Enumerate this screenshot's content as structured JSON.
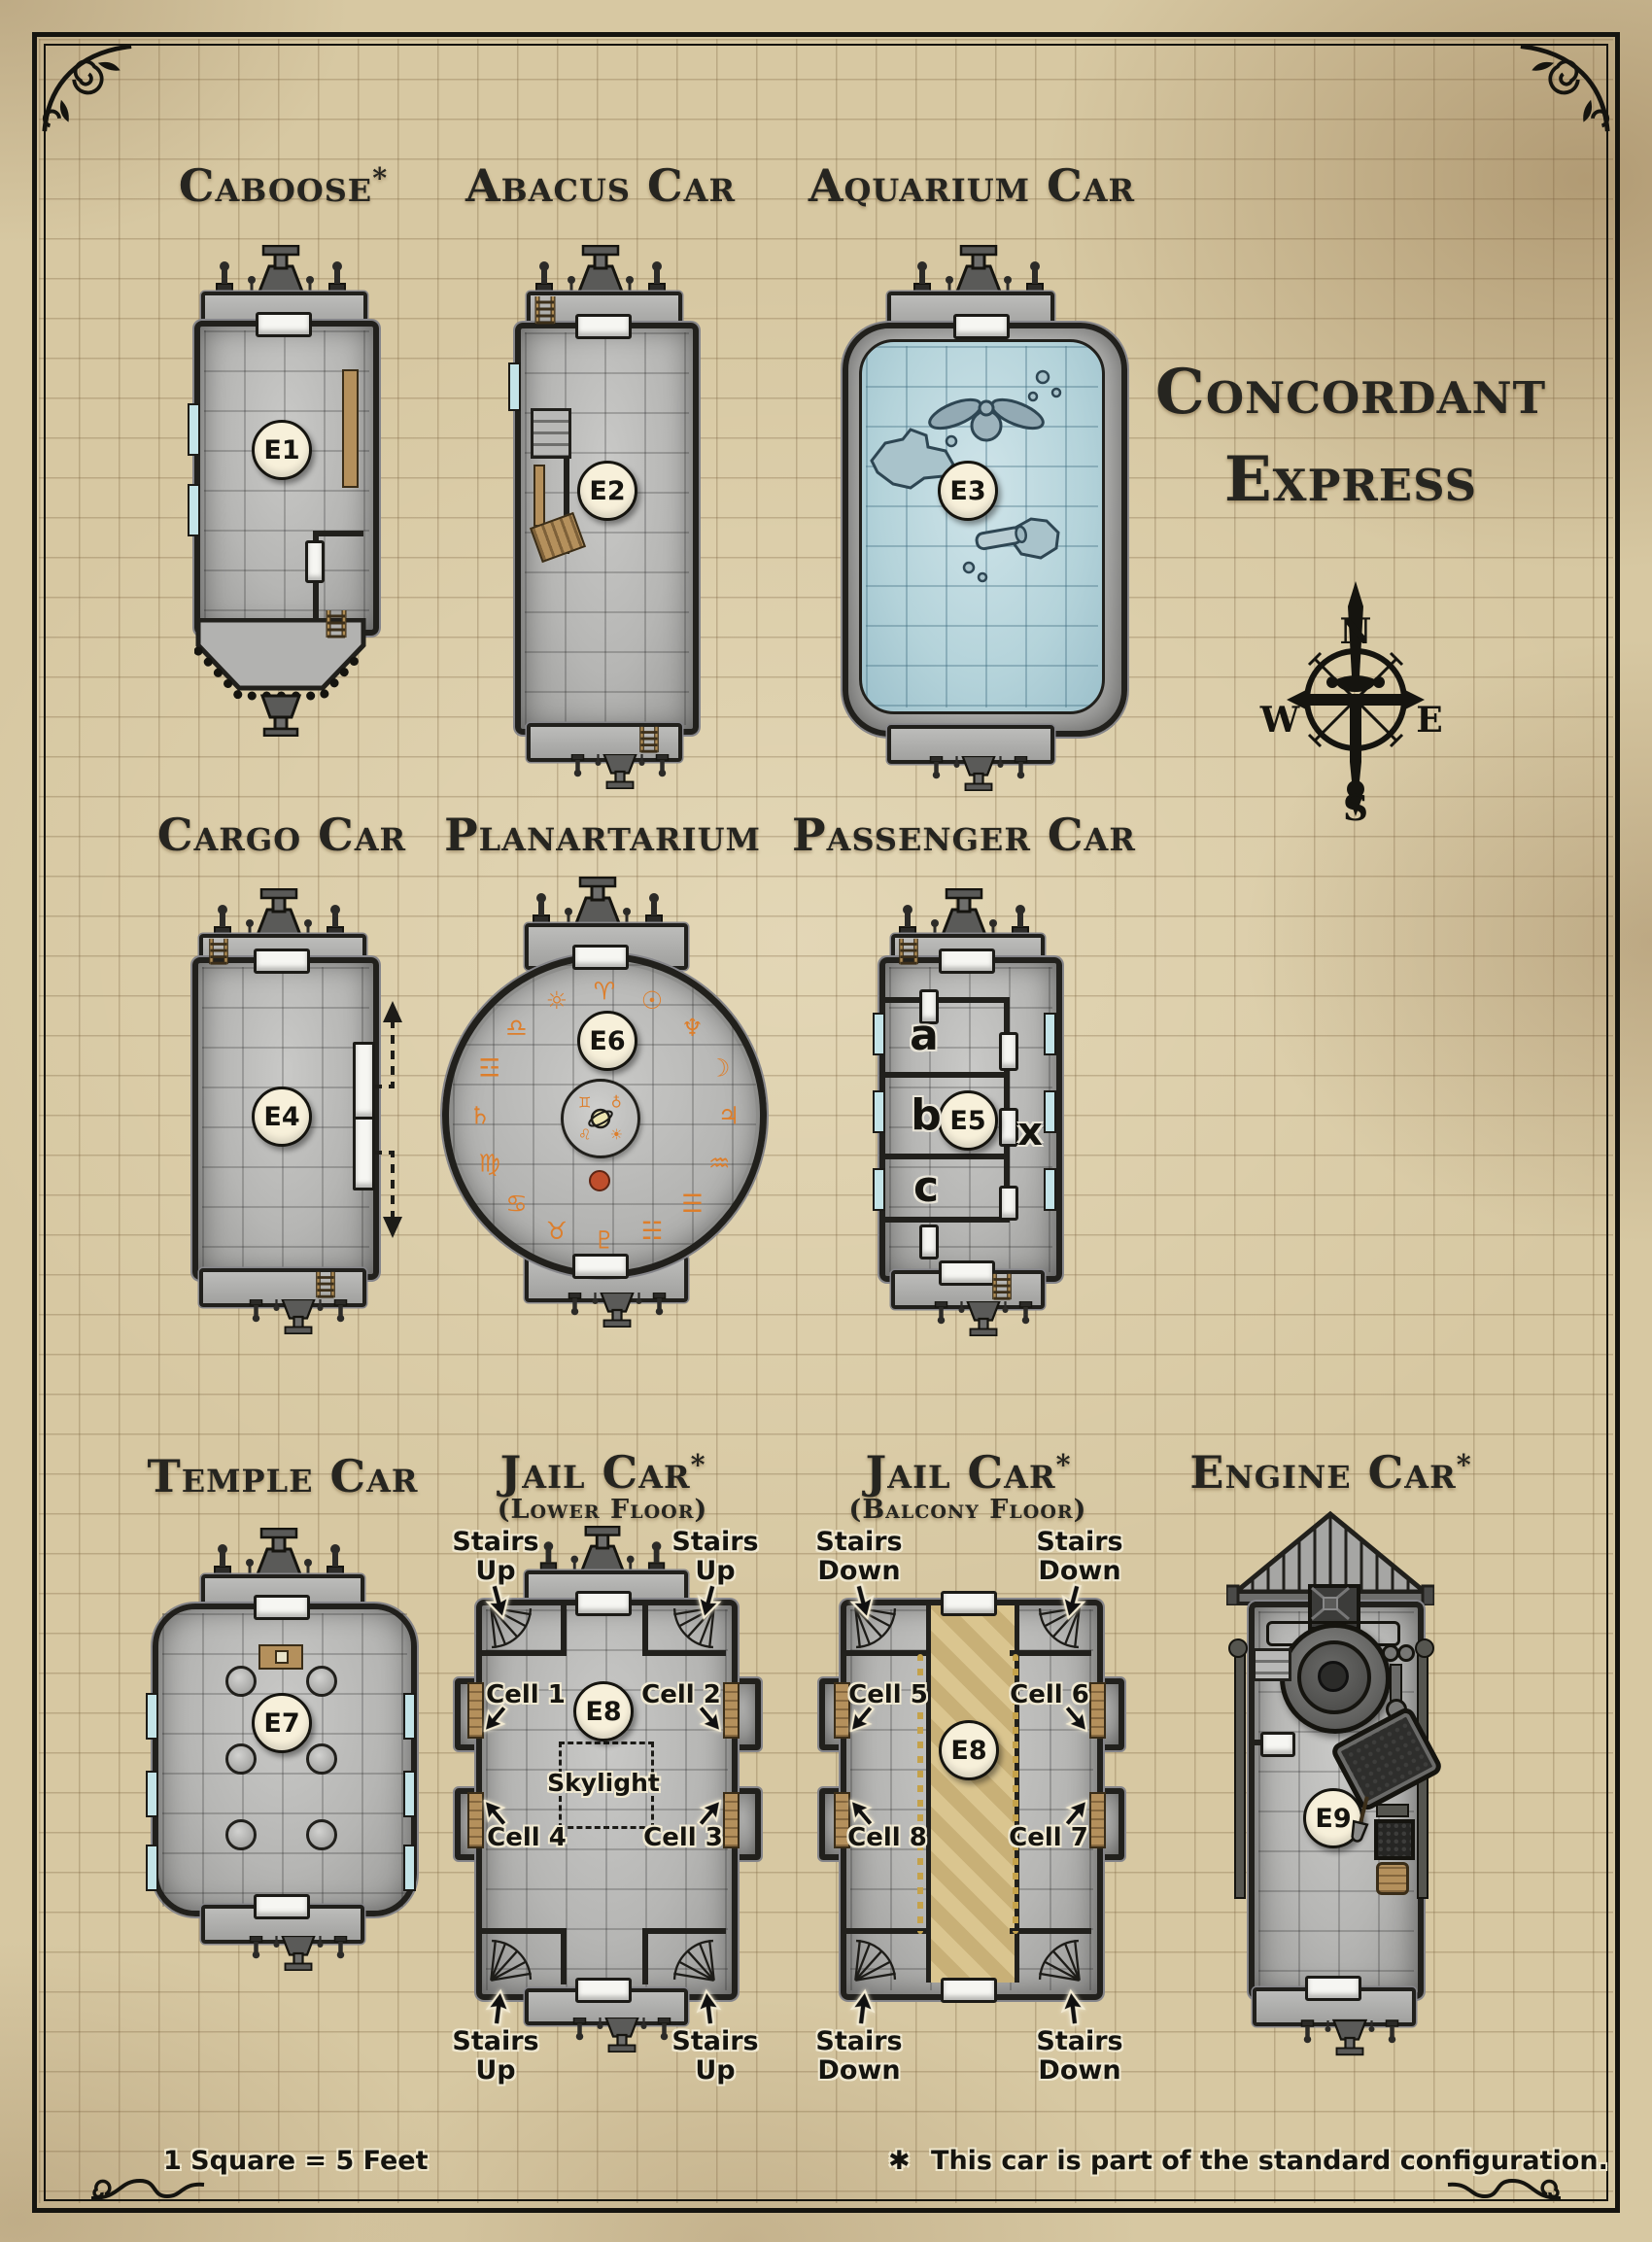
{
  "page": {
    "title_line1": "Concordant",
    "title_line2": "Express",
    "scale_note": "1 Square = 5 Feet",
    "footnote_star": "✱",
    "footnote_text": "This car is part of the standard configuration.",
    "colors": {
      "parchment": "#d7c8a2",
      "ink": "#15140f",
      "car_gray": "#b6b6b4",
      "water_blue": "#bdd9df",
      "rune_orange": "#dd7e2b",
      "wood_tan": "#b4905c",
      "marker_cream": "#f7f0da",
      "dot_red": "#bf4e2c"
    }
  },
  "compass": {
    "north": "N",
    "east": "E",
    "south": "S",
    "west": "W"
  },
  "cars": {
    "caboose": {
      "title": "Caboose",
      "star": "*",
      "marker": "E1"
    },
    "abacus": {
      "title": "Abacus Car",
      "marker": "E2"
    },
    "aquarium": {
      "title": "Aquarium Car",
      "marker": "E3"
    },
    "cargo": {
      "title": "Cargo Car",
      "marker": "E4"
    },
    "planartarium": {
      "title": "Planartarium",
      "marker": "E6",
      "rim_runes": [
        "♈",
        "☉",
        "♆",
        "☽",
        "♃",
        "♒",
        "☰",
        "☵",
        "♇",
        "♉",
        "♋",
        "♍",
        "♄",
        "☲",
        "♎",
        "☼"
      ],
      "inner_runes": [
        "♁",
        "☀",
        "♌",
        "♊"
      ]
    },
    "passenger": {
      "title": "Passenger Car",
      "marker": "E5",
      "room_a": "a",
      "room_b": "b",
      "room_c": "c",
      "corridor": "x"
    },
    "temple": {
      "title": "Temple Car",
      "marker": "E7"
    },
    "jail_lower": {
      "title": "Jail Car",
      "star": "*",
      "subtitle": "(Lower Floor)",
      "marker": "E8",
      "stairs_word": "Stairs",
      "dir_word": "Up",
      "cells": [
        "Cell 1",
        "Cell 2",
        "Cell 3",
        "Cell 4"
      ],
      "skylight": "Skylight"
    },
    "jail_balcony": {
      "title": "Jail Car",
      "star": "*",
      "subtitle": "(Balcony Floor)",
      "marker": "E8",
      "stairs_word": "Stairs",
      "dir_word": "Down",
      "cells": [
        "Cell 5",
        "Cell 6",
        "Cell 7",
        "Cell 8"
      ]
    },
    "engine": {
      "title": "Engine Car",
      "star": "*",
      "marker": "E9"
    }
  }
}
